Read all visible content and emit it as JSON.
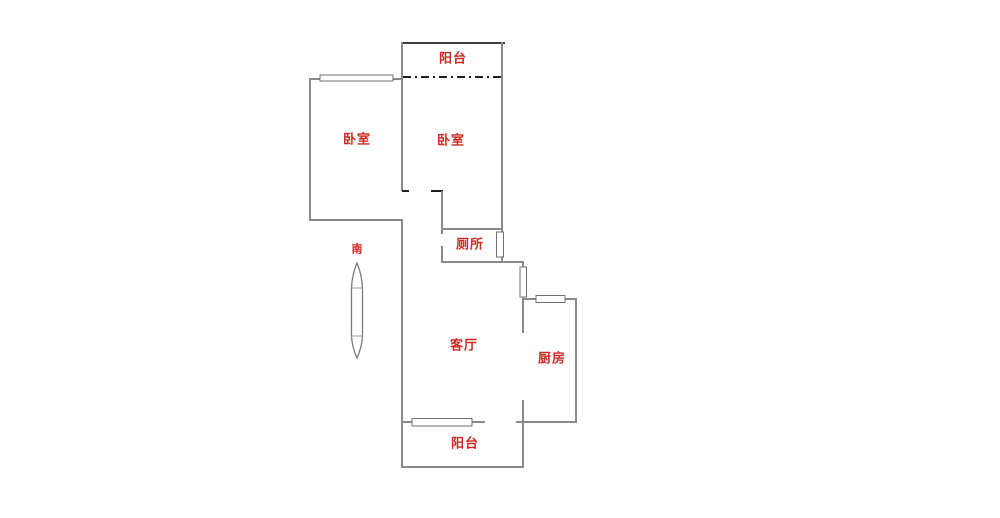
{
  "floorplan": {
    "rooms": {
      "balcony_top": {
        "label": "阳台"
      },
      "bedroom_left": {
        "label": "卧室"
      },
      "bedroom_right": {
        "label": "卧室"
      },
      "toilet": {
        "label": "厕所"
      },
      "living_room": {
        "label": "客厅"
      },
      "kitchen": {
        "label": "厨房"
      },
      "balcony_bottom": {
        "label": "阳台"
      }
    },
    "compass": {
      "south_label": "南"
    },
    "colors": {
      "background": "#ffffff",
      "label_red": "#cf2a24",
      "wall_gray": "#8a8a8a",
      "wall_dark": "#3d3d3d",
      "tick_black": "#1f1f1f",
      "window_border": "#6f6f6f"
    }
  }
}
